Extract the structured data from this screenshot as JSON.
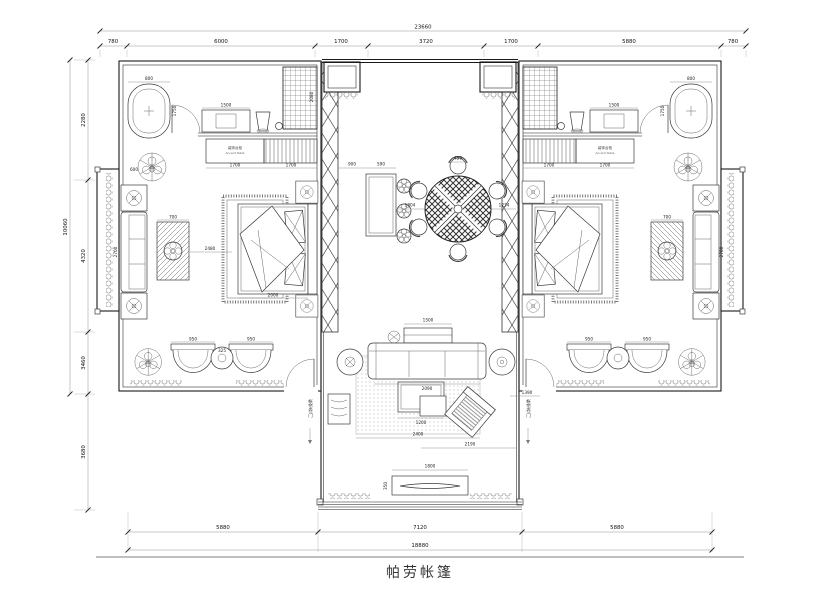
{
  "title": "帕劳帐篷",
  "dims": {
    "top_total": "23660",
    "top_segments": [
      "780",
      "6000",
      "1700",
      "3720",
      "1700",
      "5880",
      "780"
    ],
    "left_total": "10060",
    "left_segments": [
      "2280",
      "4320",
      "3460",
      "3680"
    ],
    "bottom_total": "18880",
    "bottom_segments": [
      "5880",
      "7120",
      "5880"
    ]
  },
  "labels": {
    "accent_table_cn": "装饰台柜",
    "accent_table_en": "Accent Table",
    "door_note": "帐帘卷门"
  },
  "pd": {
    "tub_w": "800",
    "tub_l": "1750",
    "vanity": "1500",
    "cab1": "1700",
    "cab2": "1700",
    "shower_h": "2080",
    "sofa_l": "2700",
    "side_tbl": "700",
    "end_tbl": "600",
    "bed_gap": "2480",
    "bed_w": "2000",
    "chair": "950",
    "lounge_tbl": "325",
    "bar_gap": "900",
    "bar_w": "590",
    "bar_tbl": "1804",
    "tbl_wall": "1234",
    "dchair": "456",
    "console": "1500",
    "sofa_w": "2090",
    "rug": "2400",
    "coffee": "1200",
    "liv_r": "2190",
    "liv_side": "1390",
    "bench_w": "1800",
    "bench_d": "350"
  }
}
